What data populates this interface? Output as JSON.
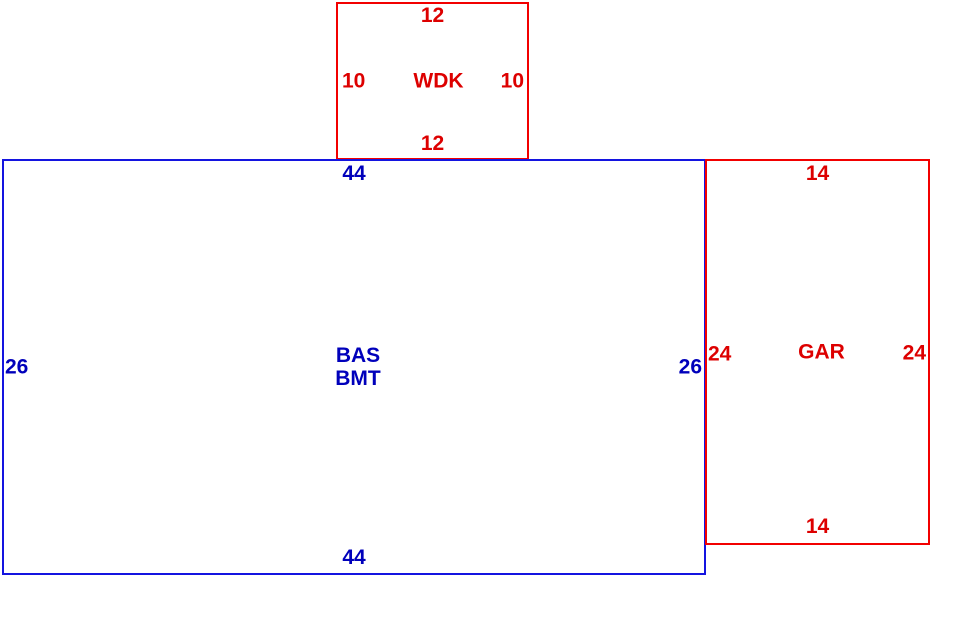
{
  "sketch": {
    "description": "Floor plan area sketch with three labeled sections",
    "colors": {
      "red_line": "#f20000",
      "red_text": "#dd0000",
      "blue_line": "#1414e0",
      "blue_text": "#0000bb",
      "background": "#ffffff"
    },
    "rooms": {
      "wdk": {
        "label": "WDK",
        "color": "red",
        "dim_top": "12",
        "dim_left": "10",
        "dim_right": "10",
        "dim_bottom": "12"
      },
      "bas": {
        "label_line1": "BAS",
        "label_line2": "BMT",
        "color": "blue",
        "dim_top": "44",
        "dim_left": "26",
        "dim_right": "26",
        "dim_bottom": "44"
      },
      "gar": {
        "label": "GAR",
        "color": "red",
        "dim_top": "14",
        "dim_left": "24",
        "dim_right": "24",
        "dim_bottom": "14"
      }
    }
  }
}
